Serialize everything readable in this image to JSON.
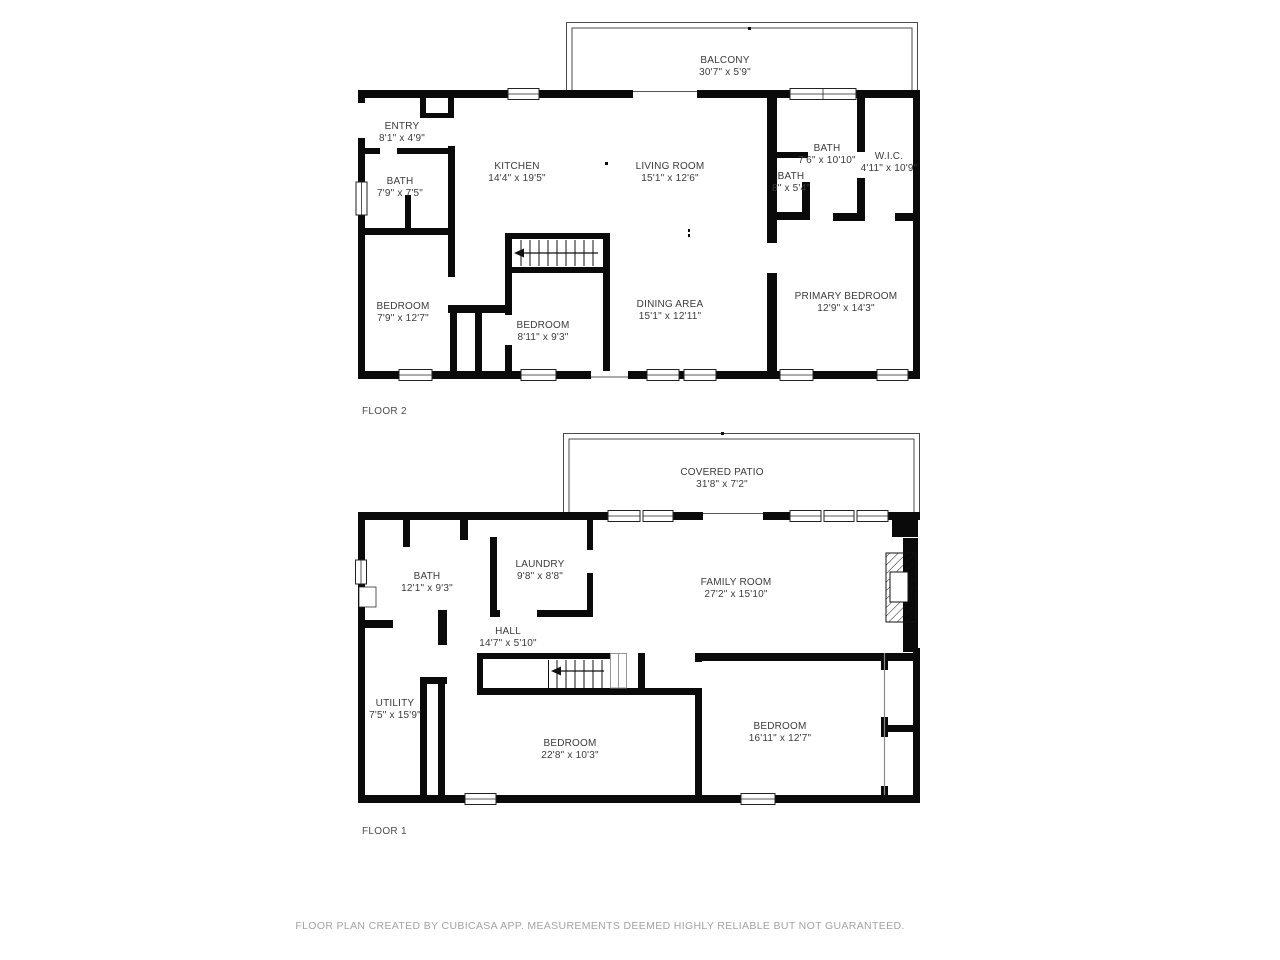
{
  "colors": {
    "wall": "#0a0a0a",
    "thin_outline": "#4a4a4a",
    "room_label": "#3b3b3b",
    "floor_label": "#4c4c4c",
    "footer_text": "#a3a3a3",
    "background": "#ffffff"
  },
  "floors": [
    {
      "label": "FLOOR 2",
      "rooms": [
        {
          "name": "BALCONY",
          "dims": "30'7\" x 5'9\""
        },
        {
          "name": "ENTRY",
          "dims": "8'1\" x 4'9\""
        },
        {
          "name": "BATH",
          "dims": "7'9\" x 7'5\""
        },
        {
          "name": "KITCHEN",
          "dims": "14'4\" x 19'5\""
        },
        {
          "name": "LIVING ROOM",
          "dims": "15'1\" x 12'6\""
        },
        {
          "name": "BATH",
          "dims": "7'6\" x 10'10\""
        },
        {
          "name": "BATH",
          "dims": "8\" x 5'4\""
        },
        {
          "name": "W.I.C.",
          "dims": "4'11\" x 10'9\""
        },
        {
          "name": "BEDROOM",
          "dims": "7'9\" x 12'7\""
        },
        {
          "name": "BEDROOM",
          "dims": "8'11\" x 9'3\""
        },
        {
          "name": "DINING AREA",
          "dims": "15'1\" x 12'11\""
        },
        {
          "name": "PRIMARY BEDROOM",
          "dims": "12'9\" x 14'3\""
        }
      ]
    },
    {
      "label": "FLOOR 1",
      "rooms": [
        {
          "name": "COVERED PATIO",
          "dims": "31'8\" x 7'2\""
        },
        {
          "name": "BATH",
          "dims": "12'1\" x 9'3\""
        },
        {
          "name": "LAUNDRY",
          "dims": "9'8\" x 8'8\""
        },
        {
          "name": "FAMILY ROOM",
          "dims": "27'2\" x 15'10\""
        },
        {
          "name": "HALL",
          "dims": "14'7\" x 5'10\""
        },
        {
          "name": "UTILITY",
          "dims": "7'5\" x 15'9\""
        },
        {
          "name": "BEDROOM",
          "dims": "22'8\" x 10'3\""
        },
        {
          "name": "BEDROOM",
          "dims": "16'11\" x 12'7\""
        }
      ]
    }
  ],
  "footer": {
    "text": "FLOOR PLAN CREATED BY CUBICASA APP. MEASUREMENTS DEEMED HIGHLY RELIABLE BUT NOT GUARANTEED."
  }
}
